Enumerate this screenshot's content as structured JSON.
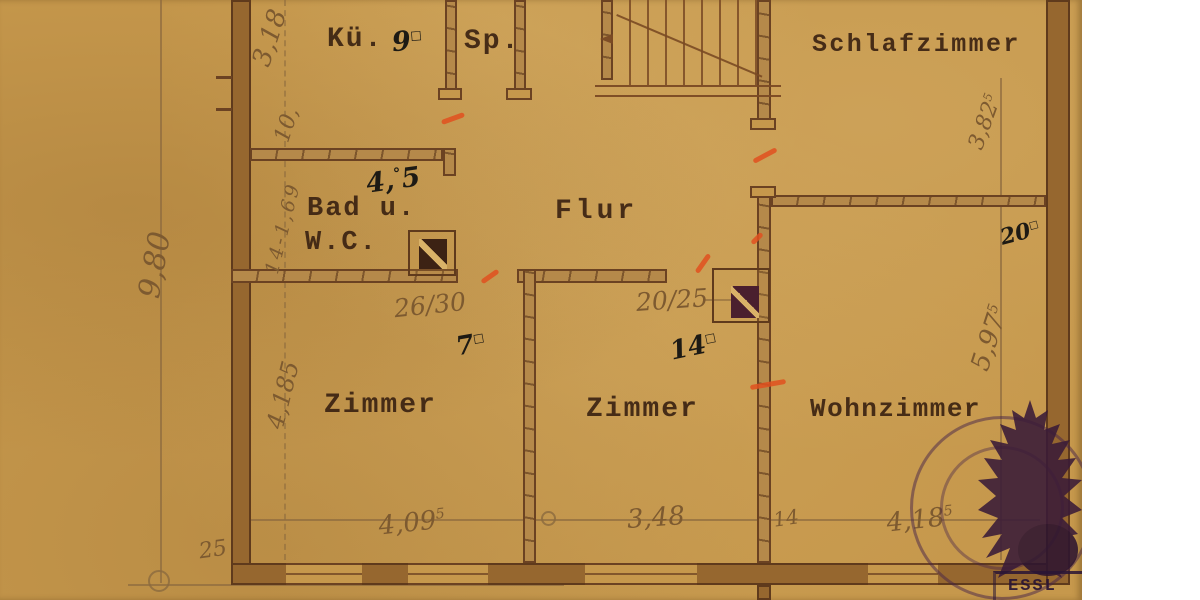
{
  "colors": {
    "paper": "#c6984c",
    "wall_line": "#5f3a1c",
    "pencil": "#7d5a30",
    "ink": "#1d1a14",
    "typed": "#3b2312",
    "red_mark": "#e0501e",
    "stamp": "#3a1b38"
  },
  "rooms": {
    "kueche": {
      "label": "Kü.",
      "area": "9",
      "area_sup": "□"
    },
    "speisekammer": {
      "label": "Sp."
    },
    "schlafzimmer": {
      "label": "Schlafzimmer"
    },
    "bad": {
      "label_line1": "Bad u.",
      "label_line2": "W.C.",
      "area_p1": "4,",
      "area_sup": "°",
      "area_p2": "5"
    },
    "flur": {
      "label": "Flur"
    },
    "zimmer_links": {
      "label": "Zimmer",
      "area": "7",
      "area_sup": "□"
    },
    "zimmer_mitte": {
      "label": "Zimmer",
      "area": "14",
      "area_sup": "□"
    },
    "wohnzimmer": {
      "label": "Wohnzimmer",
      "area": "20",
      "area_sup": "□"
    }
  },
  "dimensions": {
    "left_outer": "9,80",
    "left_col": {
      "d1": "3,18",
      "d2": "10,",
      "d3": "14-1,69",
      "d4": "4,185"
    },
    "right_col": {
      "r1": "3,82",
      "r1_sup": "5",
      "r2": "5,97",
      "r2_sup": "5"
    },
    "bottom": {
      "b0": "25",
      "b1": "4,09",
      "b1_sup": "5",
      "b2": "3,48",
      "b3": "14",
      "b4": "4,18",
      "b4_sup": "5"
    }
  },
  "annotations": {
    "chimney_bad": "26/30",
    "chimney_flur": "20/25"
  },
  "stamp": {
    "text": "ESSL"
  }
}
